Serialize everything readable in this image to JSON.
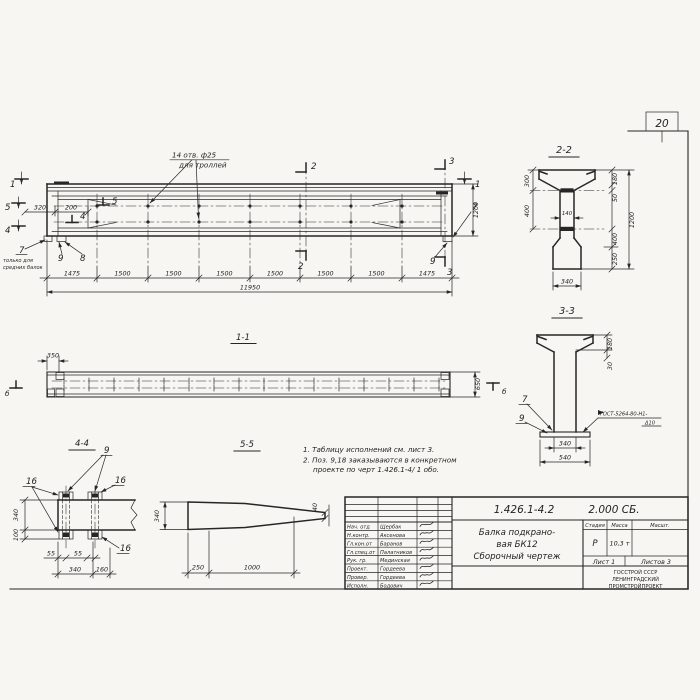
{
  "page": {
    "sheet_number": "20",
    "paper_color": "#f7f6f2",
    "ink_color": "#262626"
  },
  "notes": {
    "n1": "1. Таблицу исполнений  см. лист 3.",
    "n2": "2. Поз. 9,18 заказываются в конкретном",
    "n3": "проекте по черт 1.426.1-4/ 1 обо."
  },
  "mv": {
    "hole1": "14 отв. ф25",
    "hole2": "для троллей",
    "chain": [
      "1475",
      "1500",
      "1500",
      "1500",
      "1500",
      "1500",
      "1500",
      "1475"
    ],
    "total": "11950",
    "h1200": "1200",
    "d320": "320",
    "d200": "200",
    "mk1": "1",
    "mk2": "2",
    "mk3": "3",
    "mk4": "4",
    "mk5": "5",
    "p7": "7",
    "p8": "8",
    "p9": "9",
    "only1": "только для",
    "only2": "средних балок"
  },
  "v11": {
    "title": "1-1",
    "d350": "350",
    "d650": "650",
    "mb": "б"
  },
  "s22": {
    "title": "2-2",
    "d300": "300",
    "d400a": "400",
    "d140": "140",
    "d180": "180",
    "d50": "50",
    "d1200": "1200",
    "d400b": "400",
    "d250": "250",
    "d340": "340"
  },
  "s33": {
    "title": "3-3",
    "d180": "180",
    "d30": "30",
    "d340": "340",
    "d540": "540",
    "p7": "7",
    "p9": "9",
    "weld1": "ГОСТ-5264-80-Н1-",
    "weld2": "Δ10"
  },
  "v44": {
    "title": "4-4",
    "p9": "9",
    "p16": "16",
    "d340a": "340",
    "d100": "100",
    "d55": "55",
    "d340b": "340",
    "d160": "160"
  },
  "v55": {
    "title": "5-5",
    "d340": "340",
    "d250": "250",
    "d1000": "1000",
    "d40": "40"
  },
  "tb": {
    "doc_number": "1.426.1-4.2",
    "doc_suffix": "2.000 СБ.",
    "title1": "Балка подкрано-",
    "title2": "вая БК12",
    "title3": "Сборочный чертеж",
    "stage_label": "Стадия",
    "mass_label": "Масса",
    "scale_label": "Масшт.",
    "stage_value": "Р",
    "mass_value": "10,3 т",
    "sheet_label": "Лист 1",
    "sheets_label": "Листов 3",
    "org1": "ГОССТРОЙ СССР",
    "org2": "ЛЕНИНГРАДСКИЙ",
    "org3": "ПРОМСТРОЙПРОЕКТ",
    "rows": [
      {
        "role": "Нач. отд",
        "name": "Щербак"
      },
      {
        "role": "Н.контр.",
        "name": "Аксенова"
      },
      {
        "role": "Гл.кон.от",
        "name": "Баранов"
      },
      {
        "role": "Гл.спец.от",
        "name": "Палатников"
      },
      {
        "role": "Рук. гр.",
        "name": "Мединская"
      },
      {
        "role": "Проект.",
        "name": "Гордеева"
      },
      {
        "role": "Провер.",
        "name": "Гордеева"
      },
      {
        "role": "Исполн.",
        "name": "Бодович"
      }
    ]
  }
}
